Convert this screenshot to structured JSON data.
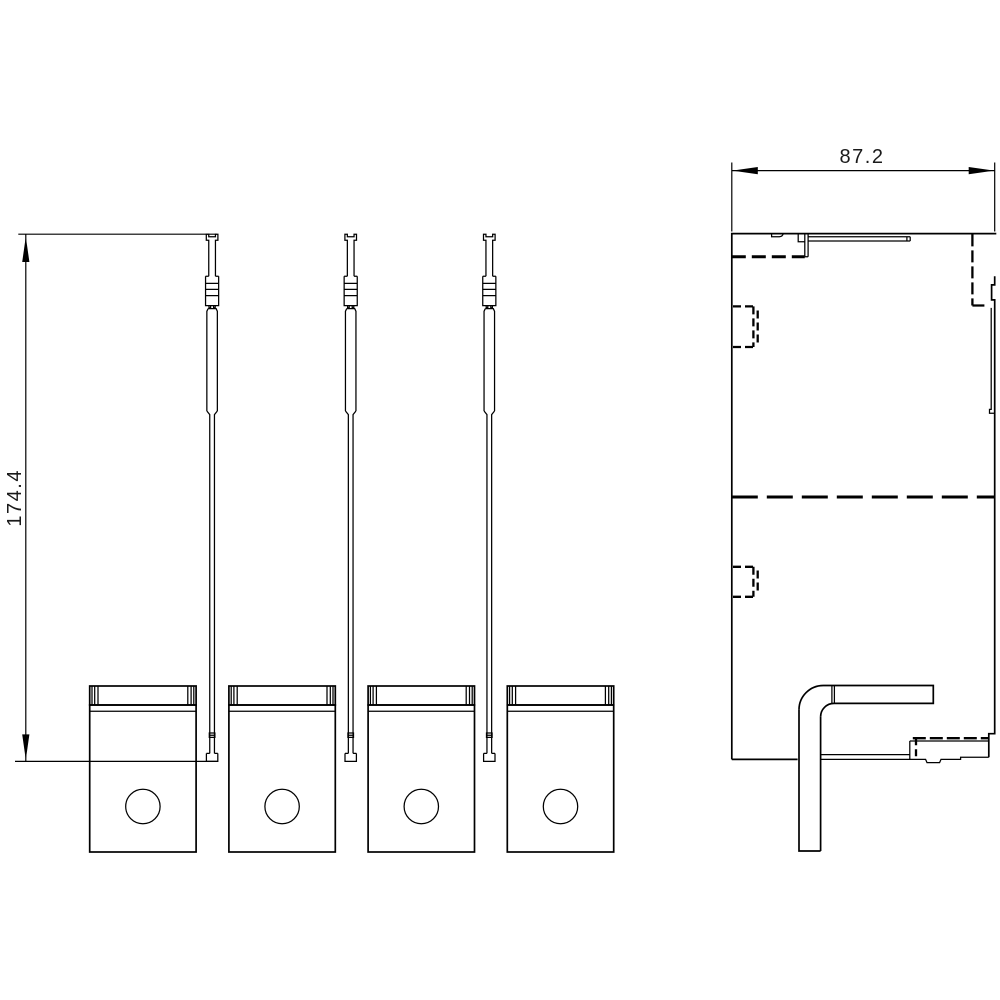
{
  "page": {
    "background": "#ffffff",
    "stroke_color": "#000000"
  },
  "drawing": {
    "type": "technical-dimension-drawing",
    "dimensions": {
      "height_label": "174.4",
      "width_label": "87.2"
    }
  }
}
